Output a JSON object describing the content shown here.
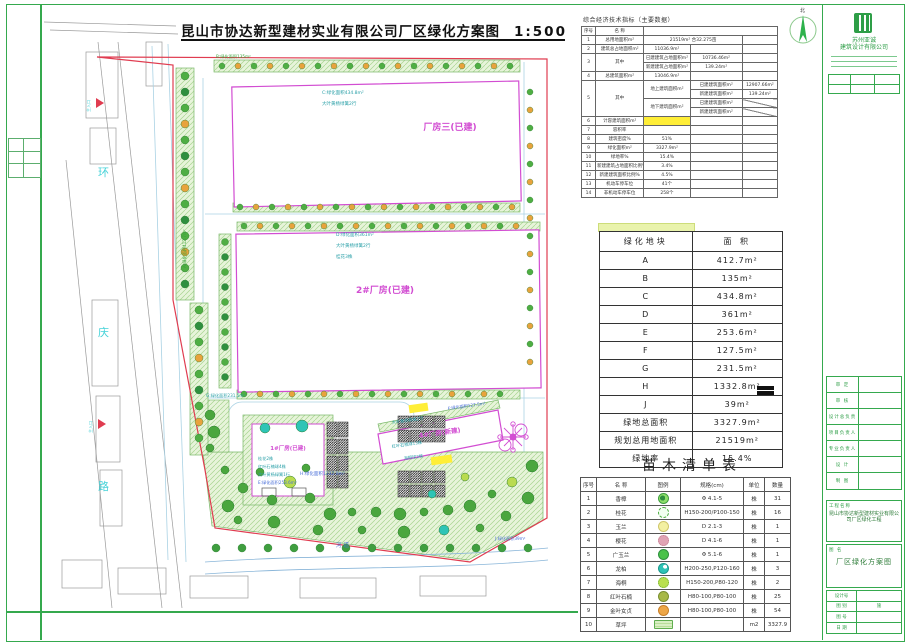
{
  "sheet": {
    "title": "昆山市协达新型建材实业有限公司厂区绿化方案图",
    "scale": "1:500"
  },
  "north": {
    "label": "北"
  },
  "indicators": {
    "title": "综合经济技术指标（主要数据）",
    "headers": {
      "no": "序号",
      "name": "名  称"
    },
    "r1": {
      "no": "1",
      "name": "总用地面积m²",
      "value": "21519m²  合32.275亩"
    },
    "r2": {
      "no": "2",
      "name": "建筑总占地面积m²",
      "value": "11036.9m²"
    },
    "r3": {
      "no": "3",
      "name": "其中",
      "a_label": "已建建筑占地面积m²",
      "a_value": "10736.46m²",
      "b_label": "新建建筑占地面积m²",
      "b_value": "139.24m²"
    },
    "r4": {
      "no": "4",
      "name": "总建筑面积m²",
      "value": "13046.9m²"
    },
    "r5": {
      "no": "5",
      "name": "其中",
      "up_label": "地上建筑面积m²",
      "up_a_label": "已建建筑面积m²",
      "up_a_value": "12907.66m²",
      "up_b_label": "新建建筑面积m²",
      "up_b_value": "139.24m²",
      "down_label": "地下建筑面积m²",
      "down_a_label": "已建建筑面积m²",
      "down_b_label": "新建建筑面积m²"
    },
    "r6": {
      "no": "6",
      "name": "计容建筑面积m²",
      "value": ""
    },
    "r7": {
      "no": "7",
      "name": "容积率",
      "value": ""
    },
    "r8": {
      "no": "8",
      "name": "建筑密度%",
      "value": "51%"
    },
    "r9": {
      "no": "9",
      "name": "绿化面积m²",
      "value": "3327.9m²"
    },
    "r10": {
      "no": "10",
      "name": "绿地率%",
      "value": "15.4%"
    },
    "r11": {
      "no": "11",
      "name": "新建建筑占地面积比例%",
      "value": "3.4%"
    },
    "r12": {
      "no": "12",
      "name": "新建建筑面积比例%",
      "value": "4.5%"
    },
    "r13": {
      "no": "13",
      "name": "机动车停车位",
      "value": "41个"
    },
    "r14": {
      "no": "14",
      "name": "非机动车停车位",
      "value": "258个"
    }
  },
  "green_table": {
    "headers": [
      "绿化地块",
      "面  积"
    ],
    "rows": [
      [
        "A",
        "412.7m²"
      ],
      [
        "B",
        "135m²"
      ],
      [
        "C",
        "434.8m²"
      ],
      [
        "D",
        "361m²"
      ],
      [
        "E",
        "253.6m²"
      ],
      [
        "F",
        "127.5m²"
      ],
      [
        "G",
        "231.5m²"
      ],
      [
        "H",
        "1332.8m²"
      ],
      [
        "J",
        "39m²"
      ],
      [
        "绿地总面积",
        "3327.9m²"
      ],
      [
        "规划总用地面积",
        "21519m²"
      ],
      [
        "绿地率",
        "15.4%"
      ]
    ]
  },
  "plant_table": {
    "title": "苗木清单表",
    "headers": [
      "序号",
      "名 称",
      "图例",
      "规格(cm)",
      "单位",
      "数量"
    ],
    "rows": [
      {
        "no": "1",
        "name": "香樟",
        "icon": "camphor",
        "spec": "Φ 4.1-5",
        "unit": "株",
        "qty": "31"
      },
      {
        "no": "2",
        "name": "桂花",
        "icon": "osmanthus",
        "spec": "H150-200/P100-150",
        "unit": "株",
        "qty": "16"
      },
      {
        "no": "3",
        "name": "玉兰",
        "icon": "magnolia",
        "spec": "D 2.1-3",
        "unit": "株",
        "qty": "1"
      },
      {
        "no": "4",
        "name": "樱花",
        "icon": "cherry",
        "spec": "D 4.1-6",
        "unit": "株",
        "qty": "1"
      },
      {
        "no": "5",
        "name": "广玉兰",
        "icon": "gwmagnolia",
        "spec": "Φ 5.1-6",
        "unit": "株",
        "qty": "1"
      },
      {
        "no": "6",
        "name": "龙柏",
        "icon": "juniper",
        "spec": "H200-250,P120-160",
        "unit": "株",
        "qty": "3"
      },
      {
        "no": "7",
        "name": "海桐",
        "icon": "pittosporum",
        "spec": "H150-200,P80-120",
        "unit": "株",
        "qty": "2"
      },
      {
        "no": "8",
        "name": "红叶石楠",
        "icon": "photinia",
        "spec": "H80-100,P80-100",
        "unit": "株",
        "qty": "25"
      },
      {
        "no": "9",
        "name": "金叶女贞",
        "icon": "ligustrum",
        "spec": "H80-100,P80-100",
        "unit": "株",
        "qty": "54"
      },
      {
        "no": "10",
        "name": "草坪",
        "icon": "lawn",
        "spec": "",
        "unit": "m2",
        "qty": "3327.9"
      }
    ]
  },
  "plan": {
    "road": [
      "环",
      "庆",
      "路"
    ],
    "river": "河道",
    "entrance": "主入口",
    "b3": "厂房三(已建)",
    "b2": "2#厂房(已建)",
    "b1": "1#厂房(已建)",
    "b4": "4#厂房(新建)",
    "la": "A:绿化面积412.7m²",
    "lb": "B:绿化面积135m²",
    "lc1": "C:绿化面积434.8m²",
    "lc2": "大叶黄杨绿篱2行",
    "ld1": "D:绿化面积361m²",
    "ld2": "大叶黄杨绿篱2行",
    "ld3": "桂花3株",
    "le1": "桂花2株",
    "le2": "红叶石楠球4株",
    "le3": "大叶黄杨绿篱1行",
    "le4": "E:绿化面积253.6m²",
    "lf1": "大叶黄杨栽植2行",
    "lf2": "红叶石楠球13株",
    "lf3": "海桐球2株",
    "lf4": "F:绿化面积127.5m²",
    "lg": "G:绿化面积231.5m²",
    "lh": "H:绿化面积1332.8m²",
    "lj": "J:绿化面积39m²"
  },
  "titleblock": {
    "company_line1": "苏州亚诚",
    "company_line2": "建筑设计有限公司",
    "sig_labels": [
      "审 定",
      "审 核",
      "设计总负责",
      "项目负责人",
      "专业负责人",
      "设 计",
      "制 图"
    ],
    "project_label": "工程名称",
    "project_value": "昆山市协达新型建材实业有限公司厂区绿化工程",
    "drawing_label": "图 名",
    "drawing_value": "厂区绿化方案图",
    "items": [
      [
        "设计号",
        ""
      ],
      [
        "图 别",
        "施"
      ],
      [
        "图 号",
        ""
      ],
      [
        "日 期",
        ""
      ]
    ]
  }
}
